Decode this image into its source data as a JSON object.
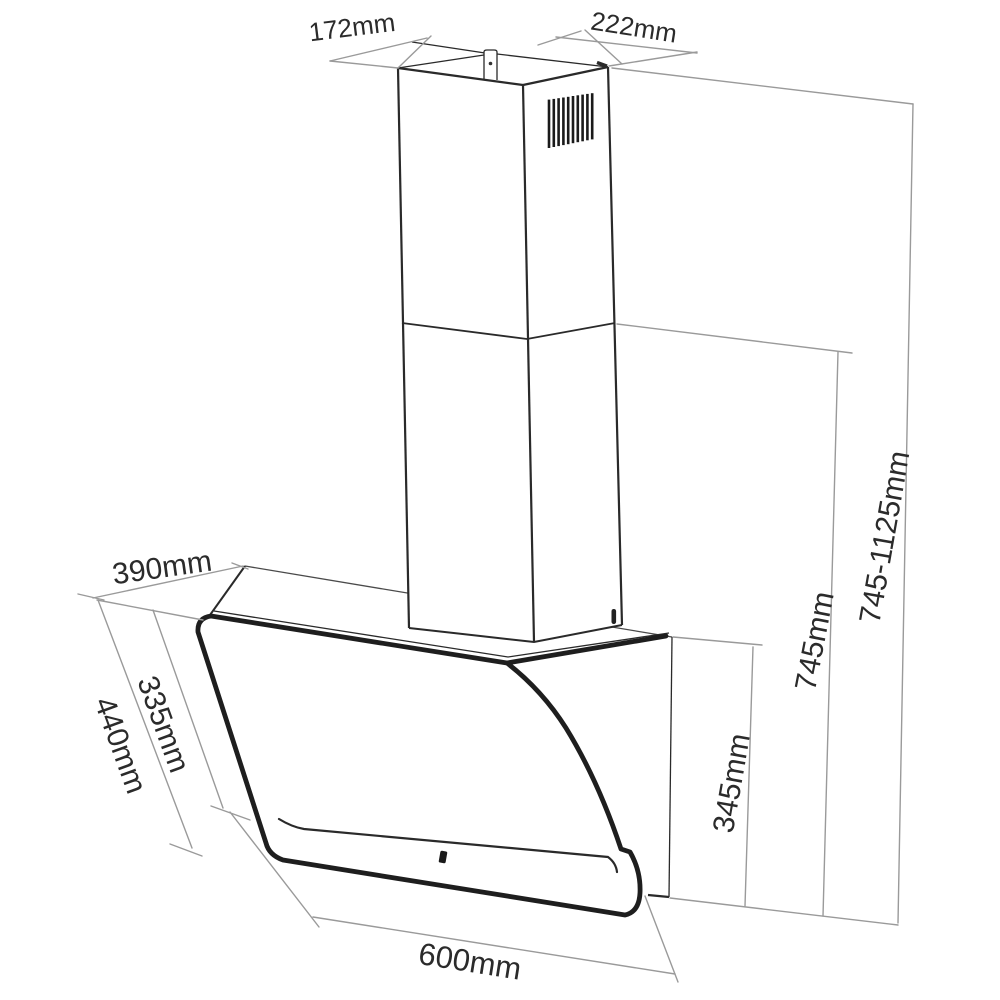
{
  "figure": {
    "type": "technical-dimension-drawing",
    "subject": "angled cooker hood with telescopic chimney"
  },
  "dimensions": {
    "chimney_top_depth": "172mm",
    "chimney_top_width": "222mm",
    "hood_top_depth": "390mm",
    "glass_inner_length": "335mm",
    "glass_panel_length": "440mm",
    "hood_width": "600mm",
    "hood_rear_height": "345mm",
    "chimney_min_height": "745mm",
    "total_height_range": "745-1125mm"
  },
  "colors": {
    "outline": "#2a2a2a",
    "dimension_line": "#9a9a9a",
    "label_text": "#2b2b2b",
    "background": "#ffffff"
  }
}
